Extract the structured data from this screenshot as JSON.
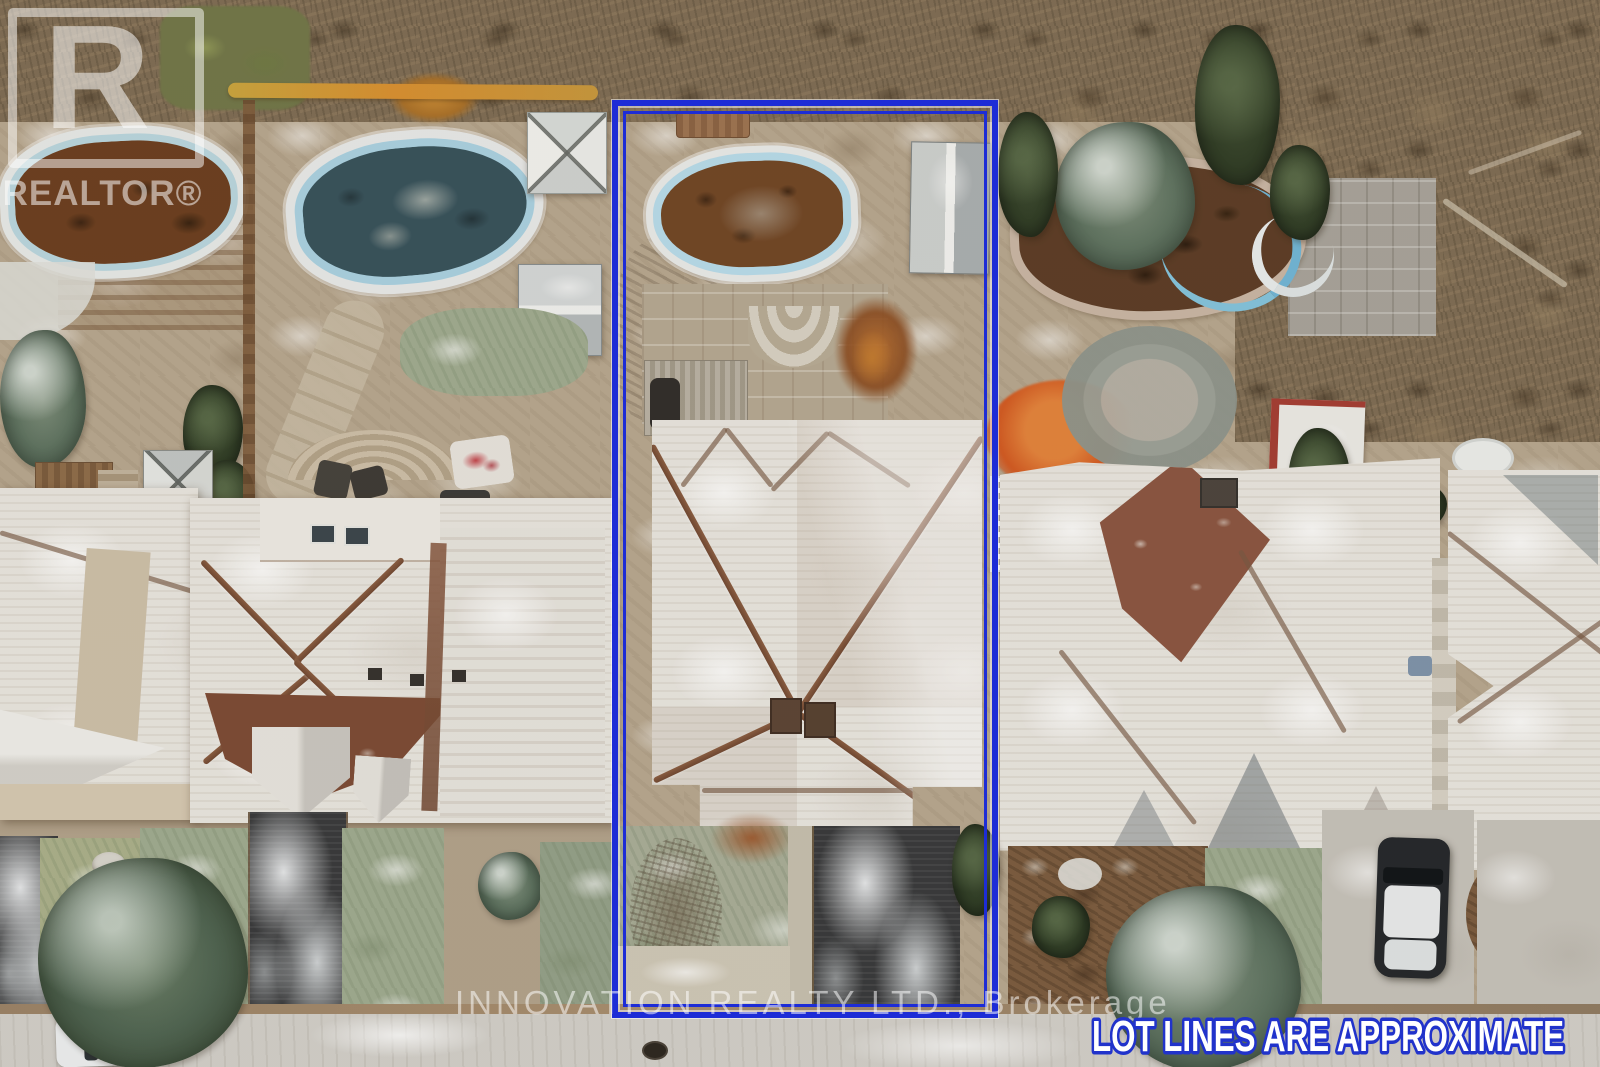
{
  "canvas": {
    "width": 1600,
    "height": 1067
  },
  "watermarks": {
    "realtor_logo_letter": "R",
    "realtor_logo_label": "REALTOR®",
    "brokerage_line": "INNOVATION REALTY LTD., Brokerage",
    "disclaimer_line": "LOT LINES ARE APPROXIMATE"
  },
  "colors": {
    "lot_line_blue": "#1d2cd6",
    "disclaimer_fill": "#ffffff",
    "disclaimer_stroke": "#2133cb",
    "watermark_white": "#ffffff",
    "snow_roof_white": "#e9e6e0",
    "roof_ridge_brown": "#7c4a34",
    "asphalt_dark": "#37383a",
    "street_gray": "#d2cfc9",
    "ground_tan": "#b7a78f",
    "pool_liner_blue": "#aed6e8",
    "pool_water_brown": "#6f4423",
    "pool_water_teal": "#34505a",
    "conifer_green": "#3d4c31",
    "autumn_orange": "#d2571f"
  }
}
